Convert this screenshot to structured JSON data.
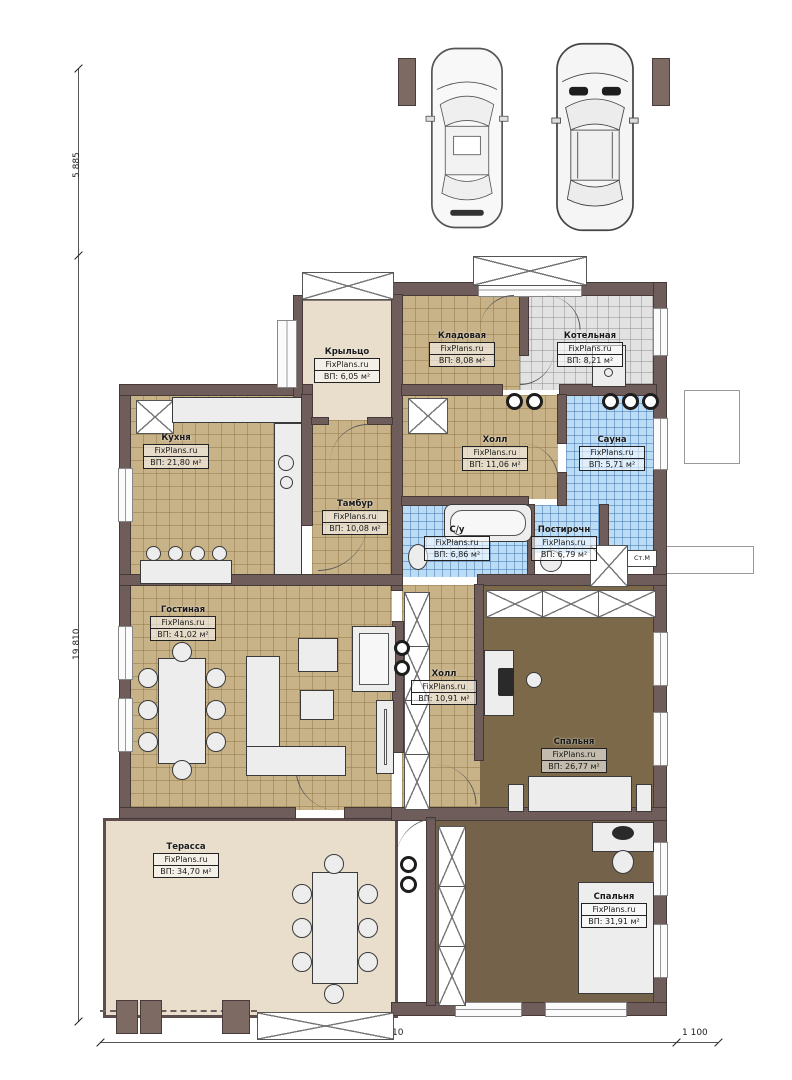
{
  "site": "FixPlans.ru",
  "dimensions": {
    "left_top": "5 885",
    "left_main": "19 810",
    "bottom_main": "14 810",
    "bottom_right": "1 100"
  },
  "annotations": {
    "washing_machine": "Ст.М"
  },
  "rooms": [
    {
      "id": "porch",
      "name": "Крыльцо",
      "brand": "FixPlans.ru",
      "area": "ВП: 6,05 м²"
    },
    {
      "id": "storage",
      "name": "Кладовая",
      "brand": "FixPlans.ru",
      "area": "ВП: 8,08 м²"
    },
    {
      "id": "boiler",
      "name": "Котельная",
      "brand": "FixPlans.ru",
      "area": "ВП: 8,21 м²"
    },
    {
      "id": "kitchen",
      "name": "Кухня",
      "brand": "FixPlans.ru",
      "area": "ВП: 21,80 м²"
    },
    {
      "id": "hall-upper",
      "name": "Холл",
      "brand": "FixPlans.ru",
      "area": "ВП: 11,06 м²"
    },
    {
      "id": "sauna",
      "name": "Сауна",
      "brand": "FixPlans.ru",
      "area": "ВП: 5,71 м²"
    },
    {
      "id": "vestibule",
      "name": "Тамбур",
      "brand": "FixPlans.ru",
      "area": "ВП: 10,08 м²"
    },
    {
      "id": "bathroom",
      "name": "С/у",
      "brand": "FixPlans.ru",
      "area": "ВП: 6,86 м²"
    },
    {
      "id": "laundry",
      "name": "Постирочн",
      "brand": "FixPlans.ru",
      "area": "ВП: 6,79 м²"
    },
    {
      "id": "living",
      "name": "Гостиная",
      "brand": "FixPlans.ru",
      "area": "ВП: 41,02 м²"
    },
    {
      "id": "hall-lower",
      "name": "Холл",
      "brand": "FixPlans.ru",
      "area": "ВП: 10,91 м²"
    },
    {
      "id": "bedroom-1",
      "name": "Спальня",
      "brand": "FixPlans.ru",
      "area": "ВП: 26,77 м²"
    },
    {
      "id": "terrace",
      "name": "Терасса",
      "brand": "FixPlans.ru",
      "area": "ВП: 34,70 м²"
    },
    {
      "id": "bedroom-2",
      "name": "Спальня",
      "brand": "FixPlans.ru",
      "area": "ВП: 31,91 м²"
    }
  ],
  "colors": {
    "wall": "#6f5d5c",
    "floor_tile_tan": "#c8b288",
    "floor_dark_brown": "#7b6949",
    "floor_blue_tile": "#badcf4",
    "floor_gray_tile": "#e2e2e2",
    "floor_beige": "#e8decb"
  }
}
